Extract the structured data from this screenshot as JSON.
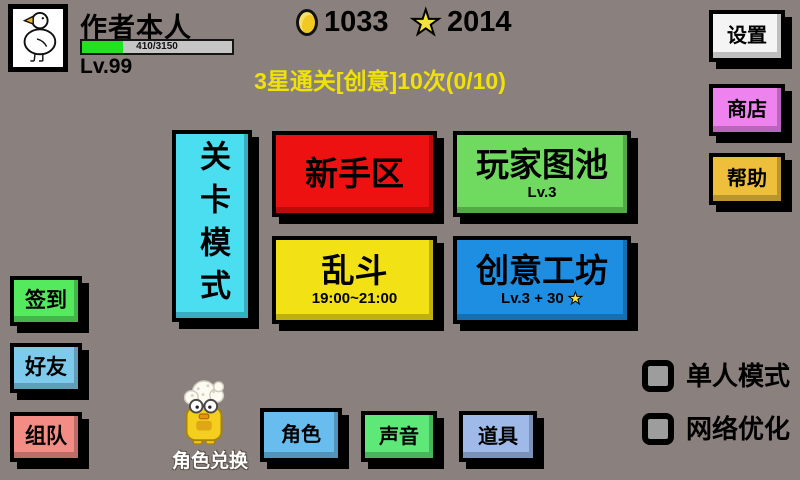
{
  "header": {
    "player": {
      "name": "作者本人",
      "level": "Lv.99",
      "exp": "410/3150",
      "exp_percent": 27
    },
    "currency": {
      "coins": "1033",
      "stars": "2014"
    },
    "mission": "3星通关[创意]10次(0/10)"
  },
  "icons": {
    "star_glyph": "★"
  },
  "colors": {
    "background": "#8a807e",
    "mission_text": "#f0e207",
    "exp_fill": "#22e022",
    "settings": "#f4f4f4",
    "shop": "#ee82ee",
    "help": "#edbf3a",
    "level_mode": "#4adef0",
    "newbie": "#ee1111",
    "player_maps": "#6fd960",
    "brawl": "#f2e215",
    "workshop": "#1e8ee2",
    "checkin": "#55e95e",
    "friends": "#7ecaec",
    "team": "#f28c84",
    "role": "#68bdee",
    "sound": "#5de878",
    "items": "#9fbae9"
  },
  "top_right_buttons": {
    "settings": "设置",
    "shop": "商店",
    "help": "帮助"
  },
  "modes": {
    "level_mode_label": "关卡模式",
    "cards": [
      {
        "label": "新手区",
        "sub": ""
      },
      {
        "label": "玩家图池",
        "sub": "Lv.3"
      },
      {
        "label": "乱斗",
        "sub": "19:00~21:00"
      },
      {
        "label": "创意工坊",
        "sub": "Lv.3 + 30"
      }
    ]
  },
  "left_buttons": {
    "checkin": "签到",
    "friends": "好友",
    "team": "组队"
  },
  "bottom": {
    "mascot_label": "角色兑换",
    "role": "角色",
    "sound": "声音",
    "items": "道具"
  },
  "toggles": [
    {
      "label": "单人模式",
      "checked": false
    },
    {
      "label": "网络优化",
      "checked": false
    }
  ]
}
